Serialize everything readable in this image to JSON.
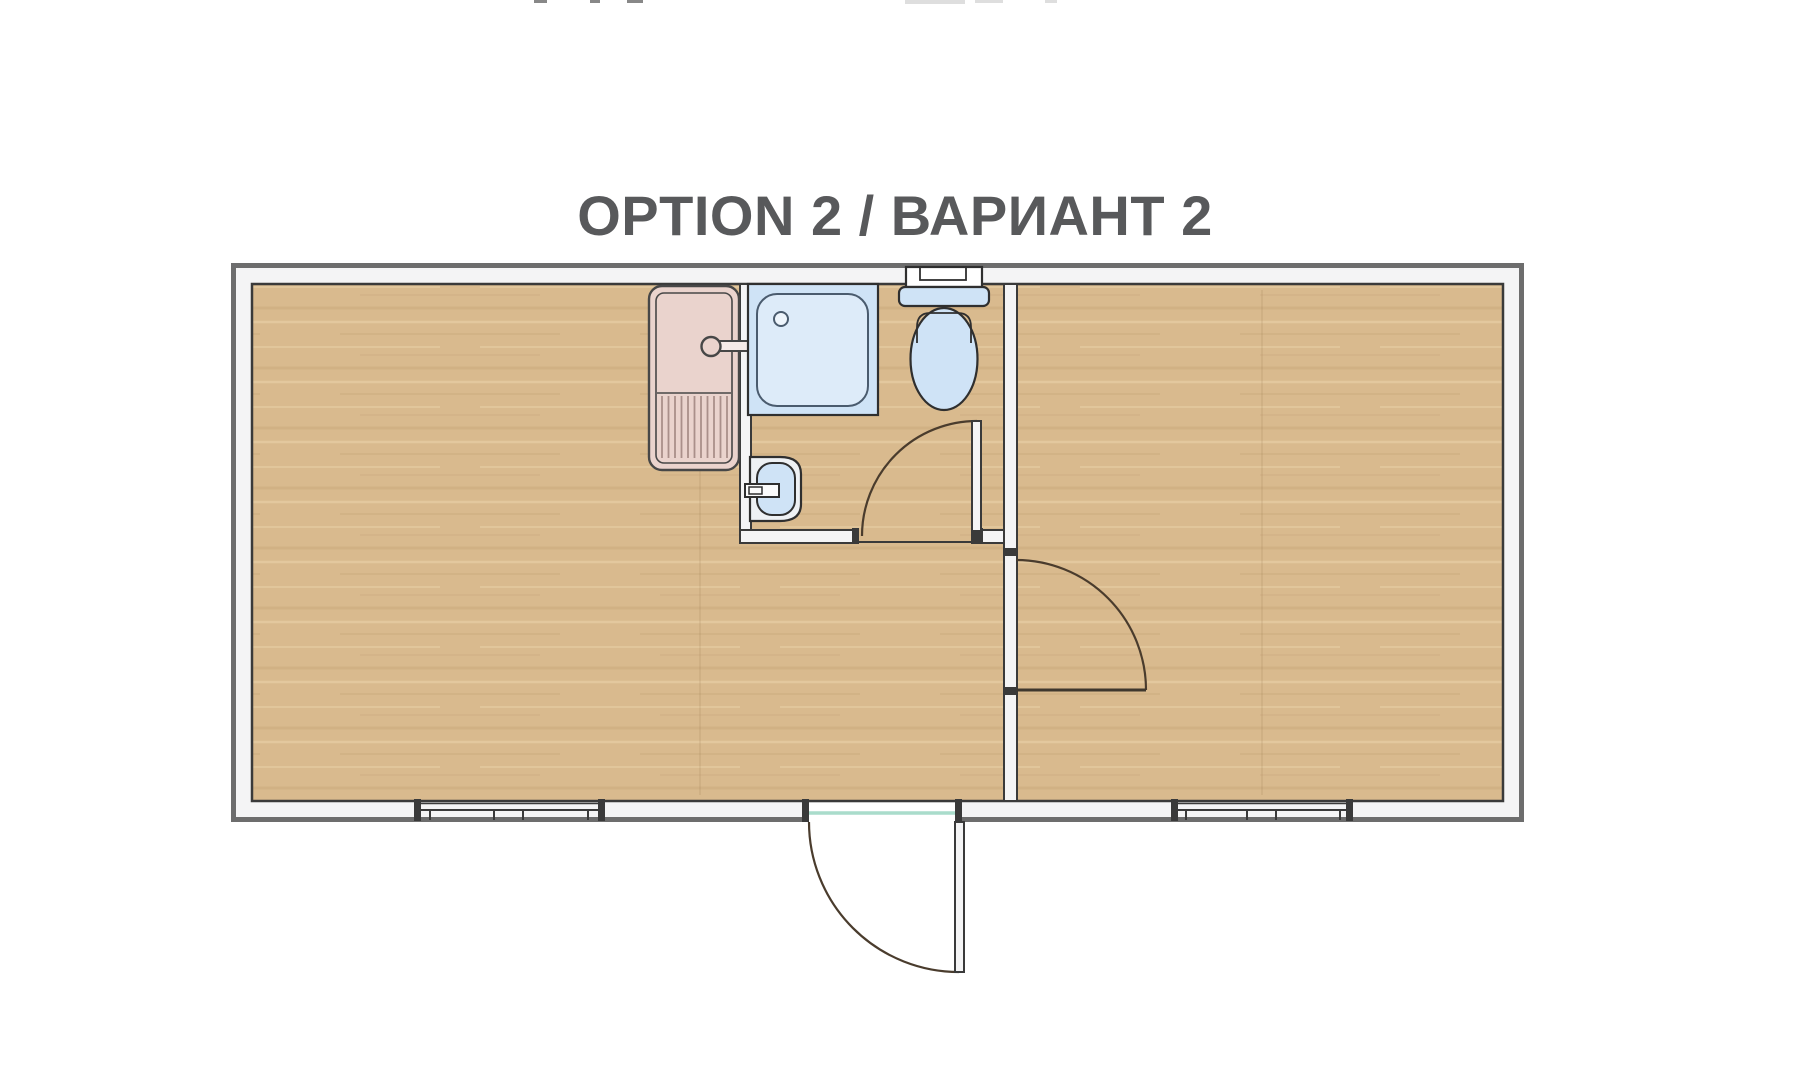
{
  "title": "OPTION 2 / ВАРИАНТ 2",
  "floor_plan": {
    "type": "modular-cabin-floor-plan",
    "rooms": [
      {
        "name": "main-room",
        "position": "left"
      },
      {
        "name": "bathroom",
        "position": "center-top"
      },
      {
        "name": "second-room",
        "position": "right"
      }
    ],
    "fixtures": [
      "sink-unit-with-drainboard",
      "shower-tray",
      "toilet-with-cistern",
      "hand-wash-basin"
    ],
    "doors": [
      "entrance-door-bottom-center",
      "bathroom-door",
      "room-divider-door"
    ],
    "windows": [
      "left-room-bottom-window",
      "right-room-bottom-window"
    ]
  },
  "colors": {
    "background": "#ffffff",
    "title_text": "#58595b",
    "wall_outer_line": "#6d6d6d",
    "wall_inner_line": "#3a3a3a",
    "wall_fill": "#f4f4f5",
    "wood_base": "#d9ba8e",
    "wood_grain_dark": "#c9a77a",
    "wood_grain_light": "#e7cfa5",
    "fixture_blue": "#cfe3f6",
    "fixture_blue_light": "#ddebf9",
    "fixture_outline": "#2f2f2f",
    "shower_outline": "#4a5b6e",
    "sink_pink": "#ead3cd",
    "sink_pink_stripe": "#aa8f8a",
    "basin_white": "#eef1f4",
    "door_arc": "#4a3c2d",
    "threshold_teal": "#a9dccb"
  }
}
